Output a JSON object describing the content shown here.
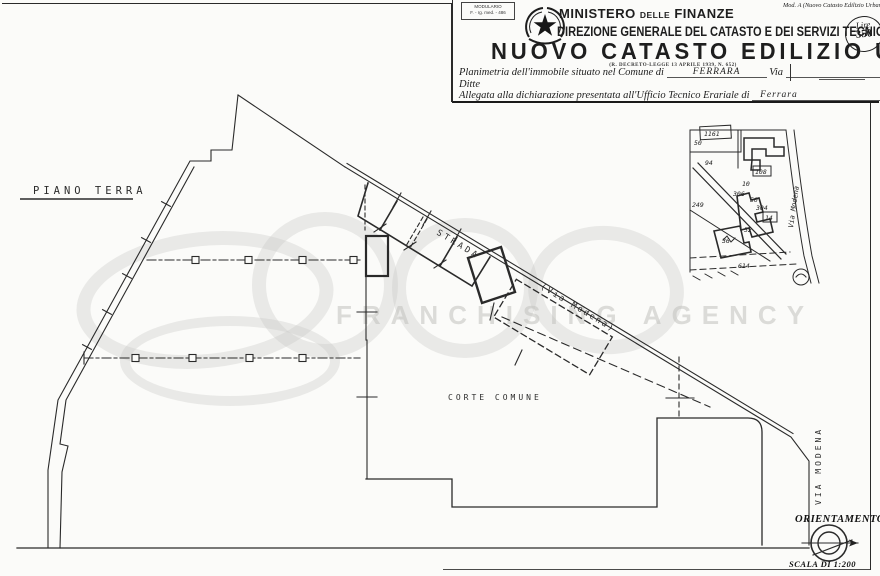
{
  "header": {
    "modulario": {
      "line1": "MODULARIO",
      "line2": "F. - rg. med. - 486"
    },
    "mod_note": "Mod. A (Nuovo Catasto Edilizio Urbano",
    "ministero": {
      "part1": "MINISTERO",
      "part2": "DELLE",
      "part3": "FINANZE"
    },
    "direzione": "DIREZIONE GENERALE DEL CATASTO E DEI SERVIZI TECNICI ERARIALI",
    "title": "NUOVO CATASTO EDILIZIO URBANO",
    "decree": "(R. DECRETO-LEGGE 13 APRILE 1939, N. 652)",
    "stamp": {
      "currency": "Lire",
      "value": "350"
    },
    "form": {
      "planimetria_label": "Planimetria dell'immobile situato nel Comune di",
      "comune_value": "FERRARA",
      "via_label": "Via",
      "ditte_label": "Ditte",
      "allegata_label": "Allegata alla dichiarazione presentata all'Ufficio Tecnico Erariale di",
      "ufficio_value": "Ferrara"
    }
  },
  "plan": {
    "floor_label": "PIANO TERRA",
    "strada_label": "STRADA",
    "via_modena_paren": "(Via Modena)",
    "corte_label": "CORTE COMUNE",
    "via_modena_vertical": "VIA MODENA",
    "orientamento_label": "ORIENTAMENTO",
    "scala_label": "SCALA DI 1:200"
  },
  "inset": {
    "via_label": "Via Modena",
    "parcels": [
      "1161",
      "50",
      "94",
      "108",
      "10",
      "249",
      "306",
      "50",
      "304",
      "14",
      "52",
      "36",
      "614"
    ]
  },
  "watermark": {
    "text": "FRANCHISING AGENCY"
  },
  "colors": {
    "ink": "#222222",
    "paper": "#fbfbf9",
    "watermark": "#c9c9c6"
  }
}
